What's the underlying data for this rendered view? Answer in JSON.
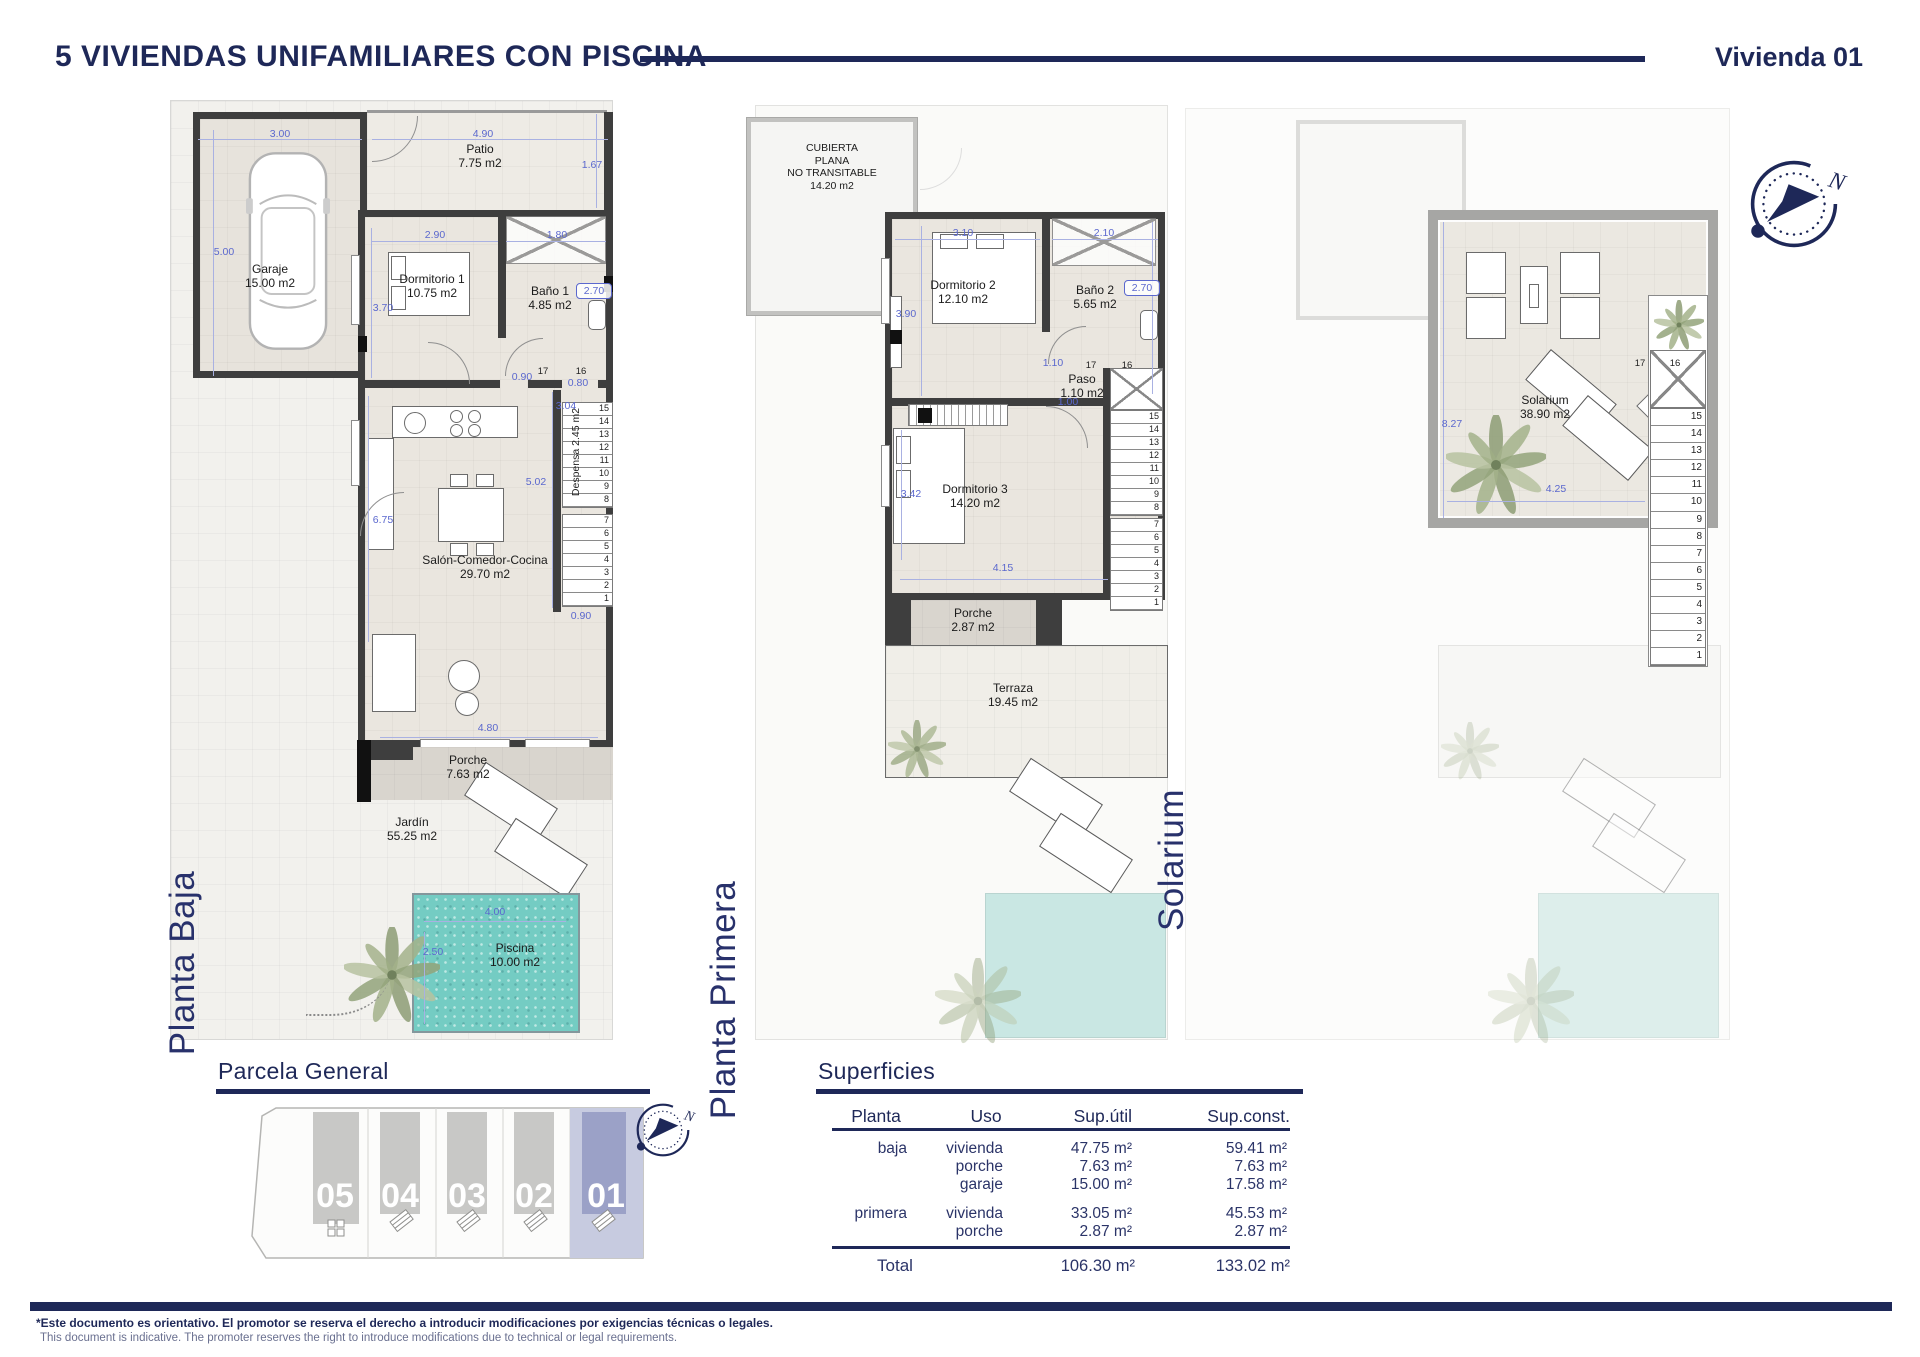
{
  "header": {
    "title": "5 VIVIENDAS UNIFAMILIARES CON PISCINA",
    "unit": "Vivienda 01"
  },
  "plan_baja": {
    "label": "Planta Baja",
    "rooms": {
      "garaje": {
        "name": "Garaje",
        "area": "15.00 m2"
      },
      "patio": {
        "name": "Patio",
        "area": "7.75 m2"
      },
      "dorm1": {
        "name": "Dormitorio 1",
        "area": "10.75 m2"
      },
      "bano1": {
        "name": "Baño 1",
        "area": "4.85 m2"
      },
      "despensa": {
        "name": "Despensa",
        "area": "2.45 m2"
      },
      "salon": {
        "name": "Salón-Comedor-Cocina",
        "area": "29.70 m2"
      },
      "porche": {
        "name": "Porche",
        "area": "7.63 m2"
      },
      "jardin": {
        "name": "Jardín",
        "area": "55.25 m2"
      },
      "piscina": {
        "name": "Piscina",
        "area": "10.00 m2"
      }
    },
    "dims": {
      "garaje_w": "3.00",
      "patio_w": "4.90",
      "garaje_h": "5.00",
      "patio_h": "1.67",
      "dorm1_w": "2.90",
      "bano1_w": "1.80",
      "dorm1_h": "3.70",
      "bano1_h": "2.70",
      "pasillo_a": "0.90",
      "pasillo_b": "0.80",
      "escalera_h": "3.04",
      "salon_h": "5.02",
      "salon_h2": "6.75",
      "escalera_w": "0.90",
      "porche_w": "4.80",
      "piscina_w": "4.00",
      "piscina_h": "2.50"
    },
    "stair_top": [
      "17",
      "16"
    ],
    "stairs_upper": [
      "15",
      "14",
      "13",
      "12",
      "11",
      "10",
      "9",
      "8"
    ],
    "stairs_lower": [
      "7",
      "6",
      "5",
      "4",
      "3",
      "2",
      "1"
    ]
  },
  "plan_primera": {
    "label": "Planta Primera",
    "cubierta": {
      "l1": "CUBIERTA",
      "l2": "PLANA",
      "l3": "NO TRANSITABLE",
      "l4": "14.20 m2"
    },
    "rooms": {
      "dorm2": {
        "name": "Dormitorio 2",
        "area": "12.10 m2"
      },
      "bano2": {
        "name": "Baño 2",
        "area": "5.65 m2"
      },
      "paso": {
        "name": "Paso",
        "area": "1.10 m2"
      },
      "dorm3": {
        "name": "Dormitorio 3",
        "area": "14.20 m2"
      },
      "porche": {
        "name": "Porche",
        "area": "2.87 m2"
      },
      "terraza": {
        "name": "Terraza",
        "area": "19.45 m2"
      }
    },
    "dims": {
      "dorm2_w": "3.10",
      "bano2_w": "2.10",
      "dorm2_h": "3.90",
      "bano2_h": "2.70",
      "paso_w": "1.10",
      "paso_w2": "1.00",
      "dorm3_h": "3.42",
      "dorm3_w": "4.15"
    },
    "stair_top": [
      "17",
      "16"
    ],
    "stairs_upper": [
      "15",
      "14",
      "13",
      "12",
      "11",
      "10",
      "9",
      "8"
    ],
    "stairs_lower": [
      "7",
      "6",
      "5",
      "4",
      "3",
      "2",
      "1"
    ]
  },
  "plan_solarium": {
    "label": "Solarium",
    "room": {
      "name": "Solarium",
      "area": "38.90 m2"
    },
    "dims": {
      "h": "8.27",
      "w": "4.25"
    },
    "stair_top": [
      "17",
      "16"
    ],
    "stairs": [
      "15",
      "14",
      "13",
      "12",
      "11",
      "10",
      "9",
      "8",
      "7",
      "6",
      "5",
      "4",
      "3",
      "2",
      "1"
    ]
  },
  "parcela": {
    "title": "Parcela General",
    "plots": [
      "05",
      "04",
      "03",
      "02",
      "01"
    ]
  },
  "superficies": {
    "title": "Superficies",
    "columns": {
      "planta": "Planta",
      "uso": "Uso",
      "util": "Sup.útil",
      "sconst": "Sup.const."
    },
    "rows": [
      {
        "planta": "baja",
        "uso": "vivienda",
        "util": "47.75 m²",
        "sconst": "59.41 m²"
      },
      {
        "planta": "",
        "uso": "porche",
        "util": "7.63 m²",
        "sconst": "7.63 m²"
      },
      {
        "planta": "",
        "uso": "garaje",
        "util": "15.00 m²",
        "sconst": "17.58 m²"
      },
      {
        "planta": "primera",
        "uso": "vivienda",
        "util": "33.05 m²",
        "sconst": "45.53 m²"
      },
      {
        "planta": "",
        "uso": "porche",
        "util": "2.87 m²",
        "sconst": "2.87 m²"
      }
    ],
    "total": {
      "label": "Total",
      "util": "106.30 m²",
      "sconst": "133.02 m²"
    }
  },
  "footer": {
    "es": "*Este documento es orientativo. El promotor se reserva el derecho a introducir modificaciones por exigencias técnicas o legales.",
    "en": "This document is indicative. The promoter reserves the right to introduce modifications due to technical or legal requirements."
  },
  "colors": {
    "navy": "#1e2858",
    "dim_blue": "#5b68ce",
    "pool": "#74ccc3",
    "wall": "#3e3e3e",
    "plot_highlight": "#9ba1c7"
  }
}
